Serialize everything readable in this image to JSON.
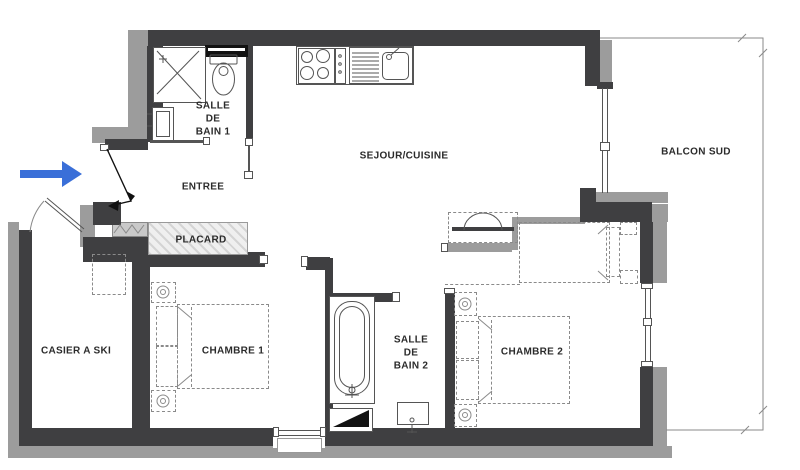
{
  "colors": {
    "wall-dark": "#3f3f41",
    "wall-gray": "#9c9c9c",
    "line": "#555555",
    "line-light": "#8a8a8a",
    "label": "#2b2b2b",
    "arrow": "#3a6fd8",
    "hatch-bg": "#efefef",
    "hatch-line": "#d4d4d4",
    "black": "#121212"
  },
  "rooms": {
    "entree": {
      "label": "ENTREE"
    },
    "sejour_cuisine": {
      "label": "SEJOUR/CUISINE"
    },
    "balcon_sud": {
      "label": "BALCON SUD"
    },
    "salle_de_bain_1": {
      "lines": [
        "SALLE",
        "DE",
        "BAIN 1"
      ]
    },
    "salle_de_bain_2": {
      "lines": [
        "SALLE",
        "DE",
        "BAIN 2"
      ]
    },
    "placard": {
      "label": "PLACARD"
    },
    "casier_a_ski": {
      "label": "CASIER A SKI"
    },
    "chambre_1": {
      "label": "CHAMBRE 1"
    },
    "chambre_2": {
      "label": "CHAMBRE 2"
    }
  }
}
